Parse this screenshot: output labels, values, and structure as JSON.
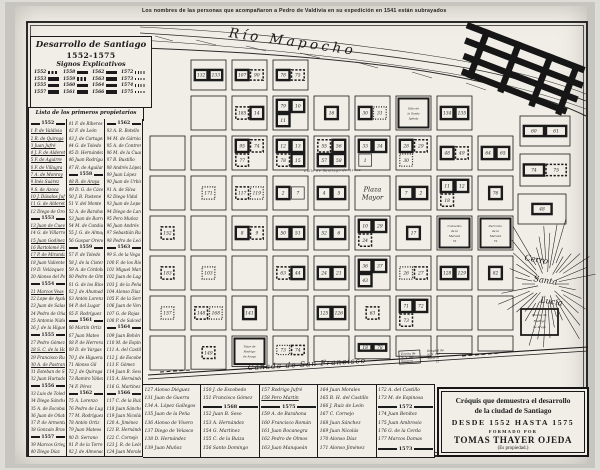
{
  "caption": "Los nombres de las personas que acompañaron a Pedro de Valdivia en su expedición en 1541 están subrayados",
  "colors": {
    "ink": "#1b1b1b",
    "paper": "#f1eee7",
    "photo_border": "#c7c5c0"
  },
  "title_block": {
    "line1": "Desarrollo de Santiago",
    "line2": "1552-1575",
    "line3": "Signos Explicativos",
    "legend": [
      {
        "year": "1552",
        "style": "h"
      },
      {
        "year": "1558",
        "style": "b"
      },
      {
        "year": "1562",
        "style": "b"
      },
      {
        "year": "1572",
        "style": "d"
      },
      {
        "year": "1553",
        "style": "b"
      },
      {
        "year": "1559",
        "style": "h"
      },
      {
        "year": "1563",
        "style": "b"
      },
      {
        "year": "1573",
        "style": "d"
      },
      {
        "year": "1555",
        "style": "b"
      },
      {
        "year": "1560",
        "style": "b"
      },
      {
        "year": "1564",
        "style": "b"
      },
      {
        "year": "1574",
        "style": "d"
      },
      {
        "year": "1557",
        "style": "b"
      },
      {
        "year": "1561",
        "style": "b"
      },
      {
        "year": "1566",
        "style": "b"
      },
      {
        "year": "1575",
        "style": "d"
      }
    ]
  },
  "owners_list": {
    "header": "Lista de los primeros propietarios",
    "col1": [
      "1552",
      "_1 P. de Valdivia",
      "_2 R. de Quiroga",
      "_3 Juan Jufré",
      "_4 J. F. de Alderete",
      "_5 F. de Aguirre",
      "_6 F. de Villagra",
      "_7 A. de Monroy",
      "_8 Inés Suárez",
      "_9 S. de Azoca",
      "_10 J. Dávalos Jufré",
      "_11 G. de Alderete",
      "12 Diego de Oro",
      "1553",
      "_13 Juan de Cuevas",
      "14 G. de Villarroel",
      "_15 Juan Godínez",
      "_16 Bartolomé Flores",
      "_17 P. de Miranda",
      "18 Juan Valiente",
      "19 D. Velázquez",
      "20 Alonso del Pozo",
      "1554",
      "_21 Marcos Veas",
      "22 Lope de Ayala",
      "23 Juan de Salas",
      "24 Pedro de Oña",
      "25 Antonio Núñez",
      "26 J. de la Higuera",
      "1555",
      "27 Pedro Gómez",
      "_28 S. C. de la Hoz",
      "29 Francisco Rubio",
      "_30 A. de Pastrana",
      "31 Esteban de Sosa",
      "32 Juan Hurtado",
      "1556",
      "33 Luis de Toledo",
      "34 Diego Sánchez",
      "35 A. de Escobar",
      "36 Juan de Oñate",
      "37 P. de Armenta",
      "38 Gonzalo Bravo",
      "1557",
      "39 Marcos Griego",
      "40 Diego Díaz"
    ],
    "col2": [
      "41 F. de Riberos",
      "42 F. de León",
      "43 J. de Cartagena",
      "44 G. de Toledo",
      "45 D. Hernández",
      "46 Juan Rodríguez",
      "47 H. de Aguilar",
      "1558",
      "_48 R. de Araya",
      "49 D. G. de Cáceres",
      "50 J. B. Pastene",
      "51 V. del Monte",
      "52 A. de Barahona",
      "53 Juan de Barros",
      "54 M. de Candia",
      "55 J. G. de Almagro",
      "56 Gaspar Orense",
      "1559",
      "57 F. de Toledo",
      "58 J. de la Cisterna",
      "59 A. de Córdoba",
      "60 Pedro de Olmos",
      "61 G. de los Ríos",
      "62 J. de Ahumada",
      "63 Antón Lorenzo",
      "64 P. del Lugar",
      "65 F. Rodríguez",
      "1561",
      "66 Martín Ortiz",
      "67 Juan Mateo",
      "68 P. de Herrera",
      "69 D. de Vargas",
      "70 J. de Higueras",
      "71 Alonso Gil",
      "72 J. de Quiroga",
      "73 Ramiro Yáñez",
      "74 F. Pérez",
      "1562",
      "75 A. Lorenzo",
      "76 Pedro de Lugo",
      "77 M. Rodríguez",
      "78 Antón Ortiz",
      "79 Juan Mateos",
      "80 D. Serrano",
      "81 P. de la Torre",
      "82 J. de Almonacid"
    ],
    "col3": [
      "1562",
      "83 A. R. Botello",
      "84 M. de Gárnica",
      "85 A. de Contreras",
      "86 M. de la Cuadra",
      "87 B. Bustillo",
      "88 Andrés López",
      "89 Juan López",
      "90 Juan de Urbina",
      "91 A. de Silva",
      "92 Diego Vidal",
      "93 Juan de Lepe",
      "94 Diego de Lara",
      "95 Pero Muñoz",
      "96 Juan Andrés",
      "97 Sebastián Ruiz",
      "98 Pedro de León",
      "1563",
      "99 S. de la Vega",
      "100 F. de los Ríos",
      "101 Miguel Martín",
      "102 Juan de Lagos",
      "103 J. de la Peña",
      "104 Alonso Díaz",
      "105 F. de la Serna",
      "106 Juan de Vera",
      "107 G. de Rojas",
      "108 P. de Salcedo",
      "1564",
      "109 Juan Bohón",
      "110 M. de Espinosa",
      "111 A. del Castillo",
      "112 J. de Escobedo",
      "113 F. Gómez",
      "114 Juan B. Seso",
      "115 A. Hernández",
      "116 G. Martínez",
      "1566",
      "117 C. de la Buiza",
      "118 Juan Sánchez",
      "119 Juan Nicolás",
      "120 A. Jiménez",
      "121 B. Hernández",
      "122 C. Cornejo",
      "123 J. R. de León",
      "124 Juan Morales"
    ]
  },
  "bottom_list": {
    "cols": [
      [
        "127 Alonso Diéguez",
        "131 Juan de Guerra",
        "134 A. López Gallegos",
        "135 Juan de la Peña",
        "136 Alonso de Vivero",
        "137 Diego de Velasco",
        "138 D. Hernández",
        "139 Juan Muñoz"
      ],
      [
        "150 J. de Escobedo",
        "151 Francisco Gómez",
        "1568",
        "152 Juan B. Seso",
        "153 A. Hernández",
        "154 G. Martínez",
        "155 C. de la Buiza",
        "156 Santo Domingo"
      ],
      [
        "157 Rodrigo Jufré",
        "_158 Pero Martín",
        "1575",
        "159 A. de Barahona",
        "160 Francisco Román",
        "161 Juan Bocanegra",
        "162 Pedro de Olmos",
        "163 Juan Manqueán"
      ],
      [
        "164 Juan Morales",
        "165 B. H. del Castillo",
        "166 J. Ruiz de León",
        "167 C. Cornejo",
        "168 Juan Sánchez",
        "169 Juan Nicolás",
        "170 Alonso Díaz",
        "171 Alonso Jiménez"
      ],
      [
        "172 A. del Castillo",
        "173 M. de Espinosa",
        "1572",
        "174 Juan Benítez",
        "175 Juan Ambrosio",
        "176 G. de la Cerda",
        "177 Marcos Damas",
        "1573"
      ]
    ]
  },
  "credit_box": {
    "line1": "Cróquis que demuestra el desarrollo",
    "line2": "de la ciudad de Santiago",
    "line3": "DESDE 1552 HASTA 1575",
    "line4": "FORMADO POR",
    "line5": "TOMAS THAYER OJEDA",
    "line6": "(Es propiedad.)"
  },
  "map": {
    "river_label": "Río Mapocho",
    "plaza_lines": [
      "Plaza",
      "Mayor"
    ],
    "canada_label": "Cañada de San Francisco",
    "cerro_lines": [
      "Cerro",
      "Santa",
      "Lucía"
    ],
    "street_label": "Calle de Santiago de Azoca",
    "ermita_label": [
      "Ermita de",
      "N. S. del",
      "Socorro"
    ],
    "hospital_label": [
      "Hospital de",
      "N. S. del",
      "Socorro",
      "15"
    ],
    "molino_label": [
      "Molino de",
      "Rodrigo",
      "de Araya"
    ],
    "blocks": [
      {
        "c": 1,
        "r": 0,
        "lots": [
          {
            "n": "132",
            "f": "b"
          },
          {
            "n": "133",
            "f": "b"
          }
        ]
      },
      {
        "c": 2,
        "r": 0,
        "lots": [
          {
            "n": "107",
            "f": "b"
          },
          {
            "n": "90",
            "f": "h"
          }
        ]
      },
      {
        "c": 3,
        "r": 0,
        "lots": [
          {
            "n": "78",
            "f": "b"
          },
          {
            "n": "75",
            "f": "h"
          }
        ]
      },
      {
        "c": 2,
        "r": 1,
        "lots": [
          {
            "n": "185",
            "f": "h"
          },
          {
            "n": "14",
            "f": "b"
          }
        ]
      },
      {
        "c": 3,
        "r": 1,
        "lots": [
          {
            "n": "79",
            "f": "b"
          },
          {
            "n": "10",
            "f": "b"
          },
          {
            "n": "11",
            "f": "b"
          }
        ]
      },
      {
        "c": 4,
        "r": 1,
        "lots": [
          {
            "n": "16",
            "f": "b"
          }
        ]
      },
      {
        "c": 5,
        "r": 1,
        "lots": [
          {
            "n": "30",
            "f": "b"
          },
          {
            "n": "31",
            "f": "d"
          }
        ]
      },
      {
        "c": 6,
        "r": 1,
        "label_lines": [
          "Sitio de",
          "la Santa",
          "Iglesia"
        ]
      },
      {
        "c": 7,
        "r": 1,
        "lots": [
          {
            "n": "134",
            "f": "b"
          },
          {
            "n": "135",
            "f": "b"
          }
        ]
      },
      {
        "c": 2,
        "r": 2,
        "lots": [
          {
            "n": "95",
            "f": "b"
          },
          {
            "n": "74",
            "f": "h"
          },
          {
            "n": "77",
            "f": "h"
          }
        ]
      },
      {
        "c": 3,
        "r": 2,
        "lots": [
          {
            "n": "12",
            "f": "b"
          },
          {
            "n": "13",
            "f": "b"
          },
          {
            "n": "78",
            "f": "h"
          },
          {
            "n": "15",
            "f": "b"
          }
        ]
      },
      {
        "c": 4,
        "r": 2,
        "lots": [
          {
            "n": "55",
            "f": "h"
          },
          {
            "n": "56",
            "f": "b"
          },
          {
            "n": "57",
            "f": "b"
          },
          {
            "n": "58",
            "f": "b"
          }
        ]
      },
      {
        "c": 5,
        "r": 2,
        "lots": [
          {
            "n": "33",
            "f": "b"
          },
          {
            "n": "34",
            "f": "b"
          },
          {
            "n": "1",
            "f": "p"
          }
        ]
      },
      {
        "c": 6,
        "r": 2,
        "lots": [
          {
            "n": "28",
            "f": "b"
          },
          {
            "n": "29",
            "f": "h"
          },
          {
            "n": "30",
            "f": "d"
          }
        ]
      },
      {
        "c": 7,
        "r": 2,
        "lots": [
          {
            "n": "48",
            "f": "b"
          },
          {
            "n": "49",
            "f": "h"
          }
        ]
      },
      {
        "c": 8,
        "r": 2,
        "lots": [
          {
            "n": "64",
            "f": "b"
          },
          {
            "n": "65",
            "f": "b"
          }
        ]
      },
      {
        "c": 1,
        "r": 3,
        "lots": [
          {
            "n": "171",
            "f": "d"
          }
        ]
      },
      {
        "c": 2,
        "r": 3,
        "lots": [
          {
            "n": "117",
            "f": "h"
          },
          {
            "n": "119",
            "f": "d"
          }
        ]
      },
      {
        "c": 3,
        "r": 3,
        "lots": [
          {
            "n": "2",
            "f": "b"
          },
          {
            "n": "7",
            "f": "p"
          }
        ]
      },
      {
        "c": 4,
        "r": 3,
        "lots": [
          {
            "n": "4",
            "f": "b"
          },
          {
            "n": "5",
            "f": "b"
          }
        ]
      },
      {
        "c": 5,
        "r": 3,
        "plaza": true
      },
      {
        "c": 6,
        "r": 3,
        "lots": [
          {
            "n": "7",
            "f": "b"
          },
          {
            "n": "2",
            "f": "b"
          }
        ]
      },
      {
        "c": 7,
        "r": 3,
        "lots": [
          {
            "n": "11",
            "f": "b"
          },
          {
            "n": "12",
            "f": "b"
          },
          {
            "n": "18",
            "f": "h"
          }
        ]
      },
      {
        "c": 8,
        "r": 3,
        "lots": [
          {
            "n": "76",
            "f": "b"
          }
        ]
      },
      {
        "c": 0,
        "r": 4,
        "lots": [
          {
            "n": "152",
            "f": "h"
          }
        ]
      },
      {
        "c": 2,
        "r": 4,
        "lots": [
          {
            "n": "8",
            "f": "b"
          },
          {
            "n": "9",
            "f": "h"
          }
        ]
      },
      {
        "c": 3,
        "r": 4,
        "lots": [
          {
            "n": "50",
            "f": "b"
          },
          {
            "n": "51",
            "f": "b"
          }
        ]
      },
      {
        "c": 4,
        "r": 4,
        "lots": [
          {
            "n": "52",
            "f": "b"
          },
          {
            "n": "6",
            "f": "b"
          }
        ]
      },
      {
        "c": 5,
        "r": 4,
        "lots": [
          {
            "n": "10",
            "f": "b"
          },
          {
            "n": "29",
            "f": "b"
          },
          {
            "n": "24",
            "f": "h"
          }
        ]
      },
      {
        "c": 6,
        "r": 4,
        "lots": [
          {
            "n": "17",
            "f": "b"
          }
        ]
      },
      {
        "c": 7,
        "r": 4,
        "label_lines": [
          "Convento",
          "de la",
          "Merced",
          "72"
        ]
      },
      {
        "c": 8,
        "r": 4,
        "label_lines": [
          "Del Conv.",
          "de la",
          "Merced",
          "72"
        ]
      },
      {
        "c": 0,
        "r": 5,
        "lots": [
          {
            "n": "183",
            "f": "h"
          }
        ]
      },
      {
        "c": 1,
        "r": 5,
        "lots": [
          {
            "n": "103",
            "f": "d"
          }
        ]
      },
      {
        "c": 3,
        "r": 5,
        "lots": [
          {
            "n": "63",
            "f": "h"
          },
          {
            "n": "44",
            "f": "b"
          }
        ]
      },
      {
        "c": 4,
        "r": 5,
        "lots": [
          {
            "n": "24",
            "f": "b"
          },
          {
            "n": "21",
            "f": "b"
          }
        ]
      },
      {
        "c": 5,
        "r": 5,
        "lots": [
          {
            "n": "36",
            "f": "b"
          },
          {
            "n": "37",
            "f": "b"
          },
          {
            "n": "43",
            "f": "b"
          }
        ]
      },
      {
        "c": 6,
        "r": 5,
        "lots": [
          {
            "n": "26",
            "f": "d"
          },
          {
            "n": "27",
            "f": "h"
          }
        ]
      },
      {
        "c": 7,
        "r": 5,
        "lots": [
          {
            "n": "128",
            "f": "b"
          },
          {
            "n": "129",
            "f": "b"
          }
        ]
      },
      {
        "c": 8,
        "r": 5,
        "lots": [
          {
            "n": "82",
            "f": "b"
          }
        ]
      },
      {
        "c": 0,
        "r": 6,
        "lots": [
          {
            "n": "157",
            "f": "d"
          }
        ]
      },
      {
        "c": 1,
        "r": 6,
        "lots": [
          {
            "n": "148",
            "f": "h"
          },
          {
            "n": "168",
            "f": "d"
          }
        ]
      },
      {
        "c": 2,
        "r": 6,
        "lots": [
          {
            "n": "141",
            "f": "b"
          }
        ]
      },
      {
        "c": 4,
        "r": 6,
        "lots": [
          {
            "n": "125",
            "f": "b"
          },
          {
            "n": "126",
            "f": "b"
          }
        ]
      },
      {
        "c": 5,
        "r": 6,
        "lots": [
          {
            "n": "63",
            "f": "h"
          }
        ]
      },
      {
        "c": 6,
        "r": 6,
        "lots": [
          {
            "n": "71",
            "f": "b"
          },
          {
            "n": "72",
            "f": "b"
          },
          {
            "n": "73",
            "f": "h"
          }
        ]
      },
      {
        "c": 1,
        "r": 7,
        "lots": [
          {
            "n": "149",
            "f": "h"
          }
        ]
      },
      {
        "c": 2,
        "r": 7,
        "label_lines": [
          "Tejar de",
          "Rodrigo",
          "de Araya"
        ]
      },
      {
        "c": 3,
        "r": 7,
        "lots": [
          {
            "n": "73",
            "f": "d"
          },
          {
            "n": "74",
            "f": "h"
          }
        ]
      },
      {
        "c": 5,
        "r": 7,
        "lots": [
          {
            "n": "18",
            "f": "b"
          },
          {
            "n": "78",
            "f": "b"
          }
        ]
      },
      {
        "x": 520,
        "y": 116,
        "w": 50,
        "h": 30,
        "lots": [
          {
            "n": "60",
            "f": "b"
          },
          {
            "n": "61",
            "f": "b"
          }
        ]
      },
      {
        "x": 520,
        "y": 154,
        "w": 50,
        "h": 32,
        "lots": [
          {
            "n": "74",
            "f": "b"
          },
          {
            "n": "75",
            "f": "h"
          }
        ]
      },
      {
        "x": 518,
        "y": 194,
        "w": 48,
        "h": 30,
        "lots": [
          {
            "n": "48",
            "f": "b"
          }
        ]
      }
    ]
  }
}
